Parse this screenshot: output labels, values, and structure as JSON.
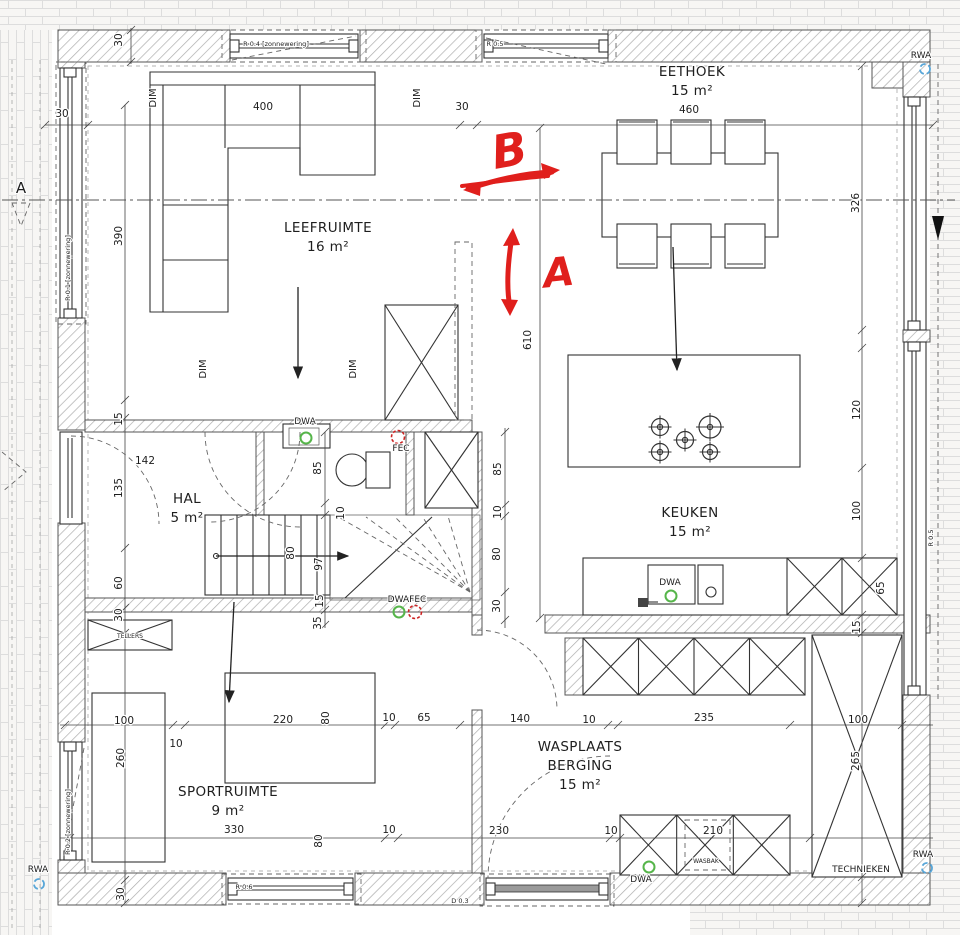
{
  "plan": {
    "type": "floor-plan",
    "level": "ground floor",
    "units": "cm"
  },
  "colors": {
    "annotation_red": "#e01f1c",
    "service_green": "#56b54a",
    "service_red": "#cc2222",
    "rwa_blue": "#58a6d8",
    "line": "#333333",
    "hatch": "#adadad"
  },
  "rooms": [
    {
      "lines": [
        "LEEFRUIMTE",
        "16 m²"
      ],
      "x": 328,
      "y": 232
    },
    {
      "lines": [
        "EETHOEK",
        "15 m²"
      ],
      "x": 692,
      "y": 76
    },
    {
      "lines": [
        "KEUKEN",
        "15 m²"
      ],
      "x": 690,
      "y": 517
    },
    {
      "lines": [
        "HAL",
        "5 m²"
      ],
      "x": 187,
      "y": 503
    },
    {
      "lines": [
        "SPORTRUIMTE",
        "9 m²"
      ],
      "x": 228,
      "y": 796
    },
    {
      "lines": [
        "WASPLAATS",
        "BERGING",
        "15 m²"
      ],
      "x": 580,
      "y": 751
    }
  ],
  "dims": [
    {
      "t": "30",
      "x": 122,
      "y": 40,
      "r": 1
    },
    {
      "t": "30",
      "x": 62,
      "y": 117,
      "r": 0
    },
    {
      "t": "400",
      "x": 263,
      "y": 110,
      "r": 0
    },
    {
      "t": "30",
      "x": 462,
      "y": 110,
      "r": 0
    },
    {
      "t": "460",
      "x": 689,
      "y": 113,
      "r": 0
    },
    {
      "t": "390",
      "x": 122,
      "y": 236,
      "r": 1
    },
    {
      "t": "326",
      "x": 859,
      "y": 203,
      "r": 1
    },
    {
      "t": "610",
      "x": 531,
      "y": 340,
      "r": 1
    },
    {
      "t": "15",
      "x": 122,
      "y": 419,
      "r": 1
    },
    {
      "t": "142",
      "x": 145,
      "y": 464,
      "r": 0
    },
    {
      "t": "135",
      "x": 122,
      "y": 488,
      "r": 1
    },
    {
      "t": "60",
      "x": 122,
      "y": 583,
      "r": 1
    },
    {
      "t": "30",
      "x": 122,
      "y": 615,
      "r": 1
    },
    {
      "t": "85",
      "x": 321,
      "y": 468,
      "r": 1
    },
    {
      "t": "10",
      "x": 344,
      "y": 513,
      "r": 1
    },
    {
      "t": "85",
      "x": 501,
      "y": 469,
      "r": 1
    },
    {
      "t": "10",
      "x": 501,
      "y": 512,
      "r": 1
    },
    {
      "t": "80",
      "x": 500,
      "y": 554,
      "r": 1
    },
    {
      "t": "30",
      "x": 500,
      "y": 606,
      "r": 1
    },
    {
      "t": "80",
      "x": 294,
      "y": 553,
      "r": 1
    },
    {
      "t": "97",
      "x": 322,
      "y": 564,
      "r": 1
    },
    {
      "t": "15",
      "x": 323,
      "y": 601,
      "r": 1
    },
    {
      "t": "35",
      "x": 321,
      "y": 623,
      "r": 1
    },
    {
      "t": "120",
      "x": 860,
      "y": 410,
      "r": 1
    },
    {
      "t": "100",
      "x": 860,
      "y": 511,
      "r": 1
    },
    {
      "t": "65",
      "x": 884,
      "y": 588,
      "r": 1
    },
    {
      "t": "15",
      "x": 860,
      "y": 627,
      "r": 1
    },
    {
      "t": "100",
      "x": 124,
      "y": 724,
      "r": 0
    },
    {
      "t": "10",
      "x": 176,
      "y": 747,
      "r": 0
    },
    {
      "t": "220",
      "x": 283,
      "y": 723,
      "r": 0
    },
    {
      "t": "80",
      "x": 329,
      "y": 718,
      "r": 1
    },
    {
      "t": "10",
      "x": 389,
      "y": 721,
      "r": 0
    },
    {
      "t": "65",
      "x": 424,
      "y": 721,
      "r": 0
    },
    {
      "t": "140",
      "x": 520,
      "y": 722,
      "r": 0
    },
    {
      "t": "10",
      "x": 589,
      "y": 723,
      "r": 0
    },
    {
      "t": "235",
      "x": 704,
      "y": 721,
      "r": 0
    },
    {
      "t": "100",
      "x": 858,
      "y": 723,
      "r": 0
    },
    {
      "t": "260",
      "x": 124,
      "y": 758,
      "r": 1
    },
    {
      "t": "330",
      "x": 234,
      "y": 833,
      "r": 0
    },
    {
      "t": "80",
      "x": 322,
      "y": 841,
      "r": 1
    },
    {
      "t": "10",
      "x": 389,
      "y": 833,
      "r": 0
    },
    {
      "t": "230",
      "x": 499,
      "y": 834,
      "r": 0
    },
    {
      "t": "10",
      "x": 611,
      "y": 834,
      "r": 0
    },
    {
      "t": "210",
      "x": 713,
      "y": 834,
      "r": 0
    },
    {
      "t": "265",
      "x": 859,
      "y": 761,
      "r": 1
    },
    {
      "t": "30",
      "x": 124,
      "y": 894,
      "r": 1
    }
  ],
  "labels": [
    {
      "t": "DWA",
      "x": 305,
      "y": 424,
      "r": 0,
      "s": 9
    },
    {
      "t": "FEC",
      "x": 401,
      "y": 451,
      "r": 0,
      "s": 9
    },
    {
      "t": "DWAFEC",
      "x": 407,
      "y": 602,
      "r": 0,
      "s": 9
    },
    {
      "t": "DWA",
      "x": 670,
      "y": 585,
      "r": 0,
      "s": 9
    },
    {
      "t": "DWA",
      "x": 641,
      "y": 882,
      "r": 0,
      "s": 9
    },
    {
      "t": "RWA",
      "x": 921,
      "y": 58,
      "r": 0,
      "s": 9
    },
    {
      "t": "RWA",
      "x": 38,
      "y": 872,
      "r": 0,
      "s": 9
    },
    {
      "t": "RWA",
      "x": 923,
      "y": 857,
      "r": 0,
      "s": 9
    },
    {
      "t": "DIM",
      "x": 156,
      "y": 98,
      "r": 1,
      "s": 10
    },
    {
      "t": "DIM",
      "x": 420,
      "y": 98,
      "r": 1,
      "s": 10
    },
    {
      "t": "DIM",
      "x": 206,
      "y": 369,
      "r": 1,
      "s": 10
    },
    {
      "t": "DIM",
      "x": 356,
      "y": 369,
      "r": 1,
      "s": 10
    },
    {
      "t": "TECHNIEKEN",
      "x": 861,
      "y": 872,
      "r": 0,
      "s": 9
    },
    {
      "t": "TELLERS",
      "x": 130,
      "y": 638,
      "r": 0,
      "s": 6
    },
    {
      "t": "WASBAK",
      "x": 706,
      "y": 863,
      "r": 0,
      "s": 6
    },
    {
      "t": "A",
      "x": 21,
      "y": 193,
      "r": 0,
      "s": 15
    },
    {
      "t": "R 0.4 [zonnewering]",
      "x": 276,
      "y": 46,
      "r": 0,
      "s": 6.5
    },
    {
      "t": "R 0.5",
      "x": 495,
      "y": 46,
      "r": 0,
      "s": 6.5
    },
    {
      "t": "R 0.1 [zonnewering]",
      "x": 70,
      "y": 268,
      "r": 1,
      "s": 6.5
    },
    {
      "t": "R 0.2 [zonnewering]",
      "x": 70,
      "y": 822,
      "r": 1,
      "s": 6.5
    },
    {
      "t": "R 0.5",
      "x": 933,
      "y": 538,
      "r": 1,
      "s": 6.5
    },
    {
      "t": "R 0.6",
      "x": 244,
      "y": 889,
      "r": 0,
      "s": 6.5
    },
    {
      "t": "D 0.3",
      "x": 460,
      "y": 903,
      "r": 0,
      "s": 6.5
    }
  ],
  "red_annotations": {
    "letters": [
      {
        "t": "B",
        "x": 512,
        "y": 166,
        "size": 46,
        "rot": -10
      },
      {
        "t": "A",
        "x": 560,
        "y": 286,
        "size": 40,
        "rot": -6
      }
    ],
    "arrow_b": "horizontal double arrow left-right",
    "arrow_a": "vertical double arrow up-down"
  }
}
